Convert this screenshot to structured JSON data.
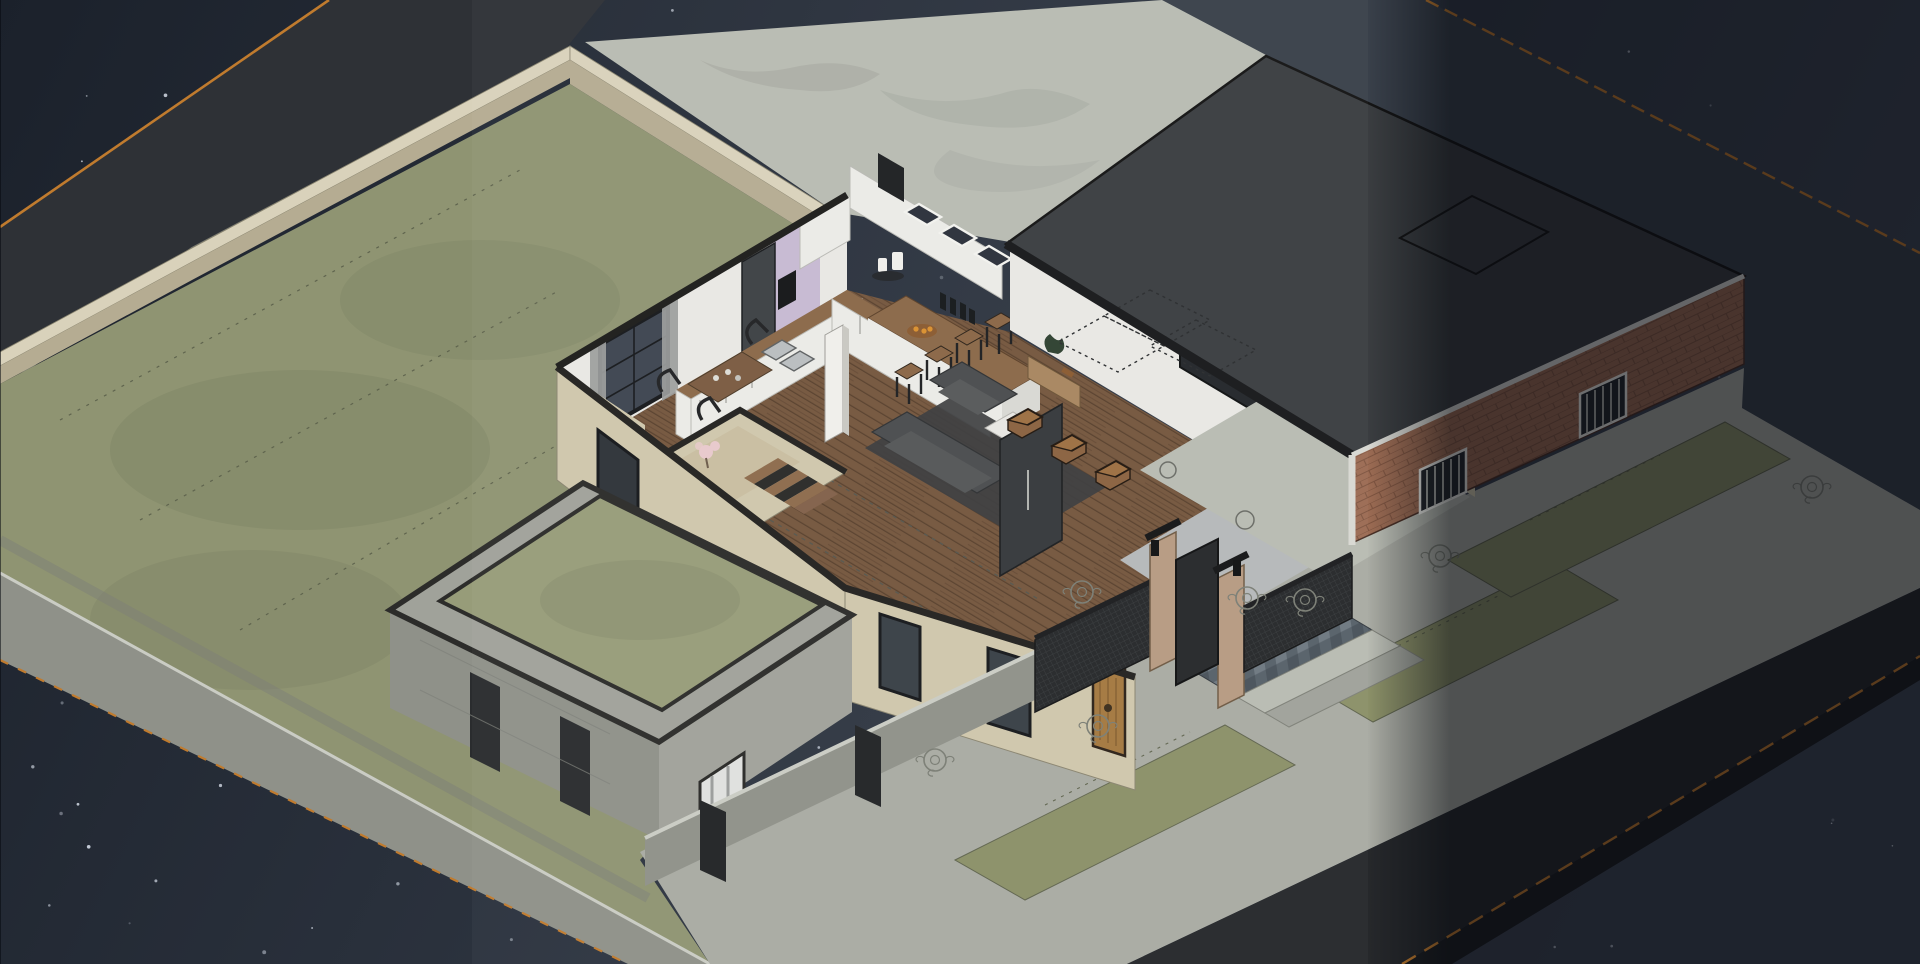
{
  "scene": {
    "view": "isometric-night-cutaway",
    "objects": [
      "sky",
      "stars",
      "north-road",
      "east-road",
      "south-road",
      "plaza-pavement",
      "perimeter-wall",
      "backyard-grass",
      "retaining-wall",
      "house-interior",
      "kitchen",
      "living-room",
      "stairwell",
      "entry",
      "patio",
      "flat-roof",
      "garage-brick-wall",
      "courtyard-enclosure",
      "street-wall",
      "metal-fence",
      "gate",
      "paver-walkway",
      "sidewalk",
      "grass-verges",
      "bushes",
      "light-band-overlays"
    ]
  },
  "colors": {
    "sky_left": "#1b212b",
    "sky_right": "#3d4552",
    "star": "#d6dde8",
    "road_north": "#2e3136",
    "road_east": "#39404a",
    "road_south": "#26282b",
    "curb_dark": "#1b1d20",
    "orange_line": "#c07b2e",
    "pavement": "#b8bbb2",
    "pavement_shade": "#9fa29a",
    "sidewalk": "#a9aba3",
    "grass": "#8f9472",
    "grass_dark": "#70765a",
    "grass_court": "#979c79",
    "verge": "#8b9068",
    "wall_beige_top": "#d9d2bb",
    "wall_beige_face": "#cfc7ac",
    "wall_beige_shadow": "#b5ac92",
    "concrete": "#8f9189",
    "concrete_light": "#a0a29a",
    "concrete_cap": "#caccc4",
    "trim_dark": "#1f2022",
    "interior_wall": "#e9e8e4",
    "accent_purple": "#c7b9d2",
    "floor_wood": "#74563d",
    "floor_wood_dark": "#573f2c",
    "counter_wood": "#8a6848",
    "cabinet_white": "#ebebe7",
    "fridge": "#3c4044",
    "roof_dark": "#3a3d40",
    "roof_line": "#141414",
    "brick": "#9b6b53",
    "brick_mortar": "#7e5440",
    "fence_dark": "#26282a",
    "pillar_brick": "#b69a82",
    "paver_blue": "#566069",
    "paver_light": "#6e7880",
    "couch": "#4a4c4e",
    "rug": "#393b3d",
    "stool_wood": "#8a6646",
    "entry_tile": "#b5b8b9",
    "door_wood": "#a4783f",
    "curtain": "#9a9c9b",
    "glass_dark": "#3d4550",
    "plant_green": "#2e4030",
    "plant_pink": "#e8c9cc",
    "fruit_orange": "#d9902f",
    "bush_stroke": "#7a7d74",
    "hidden_dash": "#55564e"
  },
  "stars": {
    "count": 170,
    "seed": 9
  },
  "bands": {
    "left_solid": 385,
    "left_fade": 472,
    "right_fade_start": 1368,
    "right_solid": 1450,
    "dim_opacity": 0.55
  }
}
